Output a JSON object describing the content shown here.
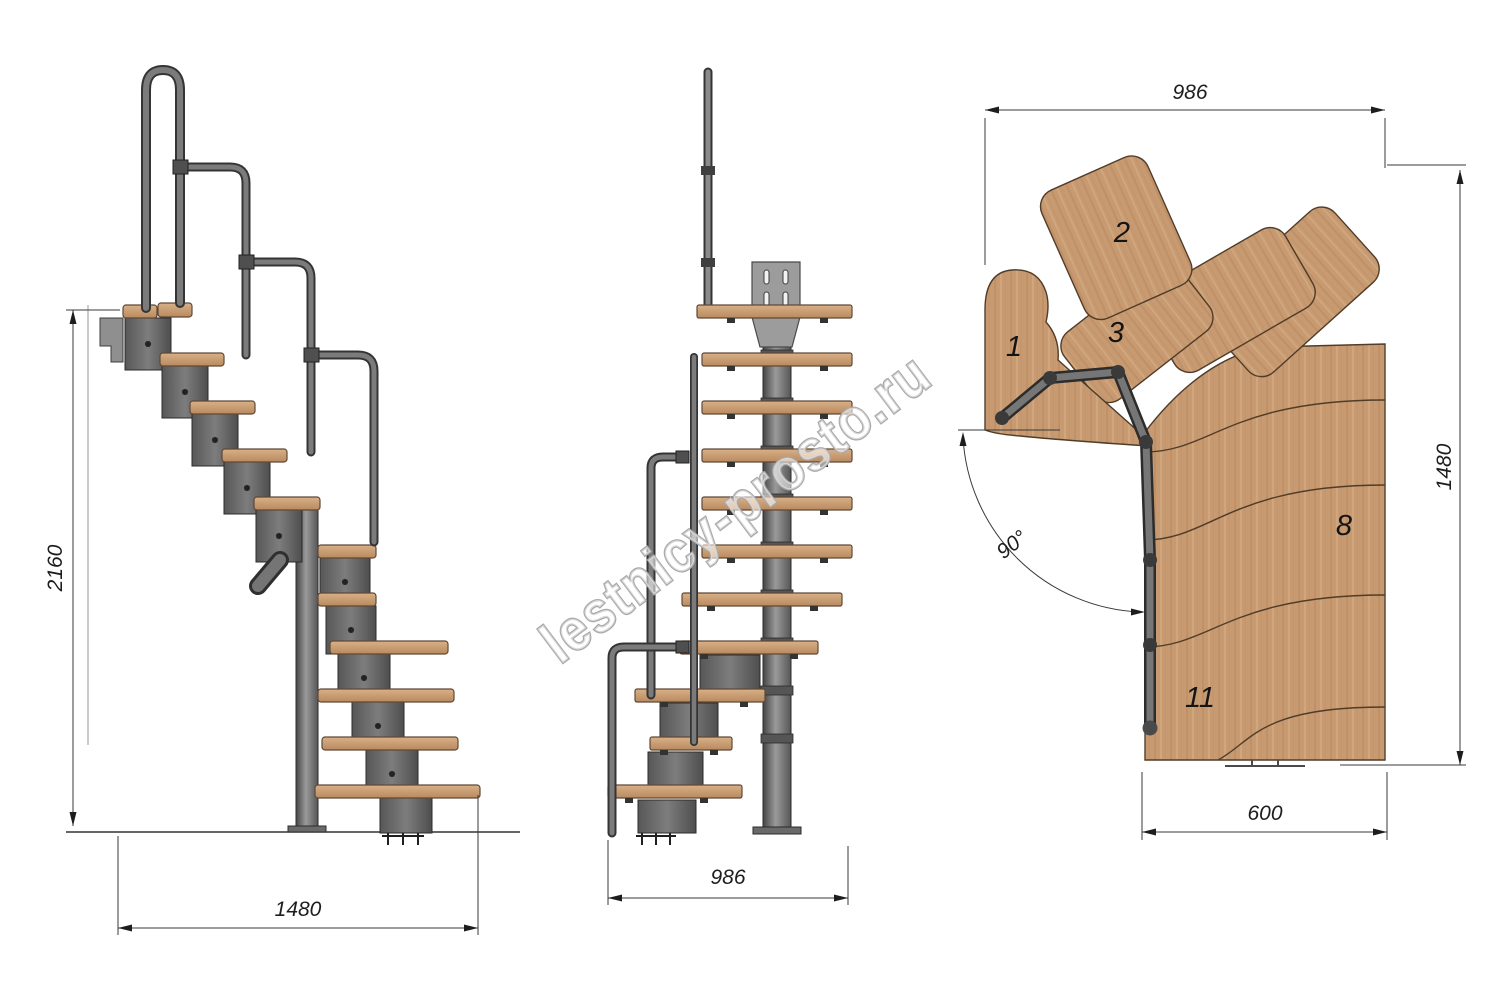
{
  "watermark": {
    "text": "lestnicy-prosto.ru"
  },
  "dimensions": {
    "side_height": "2160",
    "side_width": "1480",
    "front_width": "986",
    "plan_width_top": "986",
    "plan_depth_right": "1480",
    "plan_flight_width": "600",
    "plan_angle": "90°"
  },
  "plan_steps": [
    {
      "label": "1"
    },
    {
      "label": "2"
    },
    {
      "label": "3"
    },
    {
      "label": "8"
    },
    {
      "label": "11"
    }
  ],
  "colors": {
    "wood": "#c79a72",
    "wood_dark": "#b9895f",
    "metal": "#676767",
    "metal_dark": "#2e2e2e",
    "dimension_lines": "#3a3a3a",
    "watermark_stroke": "#a9a9a9"
  }
}
